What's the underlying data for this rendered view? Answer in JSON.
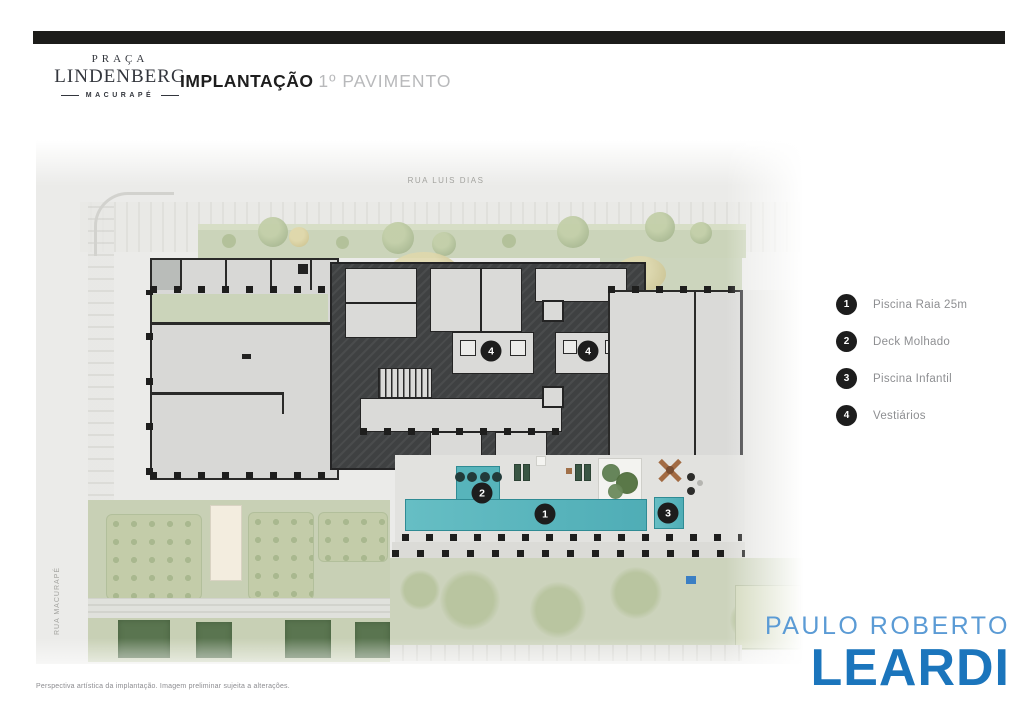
{
  "header": {
    "brand": {
      "line1": "PRAÇA",
      "line2": "LINDENBERG",
      "line3": "MACURAPÉ"
    },
    "title_bold": "IMPLANTAÇÃO",
    "title_light": "1º PAVIMENTO"
  },
  "plan": {
    "street_top": "RUA LUIS DIAS",
    "street_left": "RUA MACURAPÉ",
    "markers": [
      {
        "number": "4"
      },
      {
        "number": "4"
      },
      {
        "number": "2"
      },
      {
        "number": "1"
      },
      {
        "number": "3"
      }
    ]
  },
  "legend": {
    "items": [
      {
        "number": "1",
        "label": "Piscina Raia 25m"
      },
      {
        "number": "2",
        "label": "Deck Molhado"
      },
      {
        "number": "3",
        "label": "Piscina Infantil"
      },
      {
        "number": "4",
        "label": "Vestiários"
      }
    ]
  },
  "logo": {
    "top": "PAULO ROBERTO",
    "bottom": "LEARDI"
  },
  "footer": {
    "disclaimer": "Perspectiva artística da implantação. Imagem preliminar sujeita a alterações."
  },
  "colors": {
    "accent_blue_light": "#5b9bd5",
    "accent_blue_dark": "#1b75bc",
    "pool_teal": "#57b4bb",
    "legend_circle": "#1d1d1d"
  }
}
